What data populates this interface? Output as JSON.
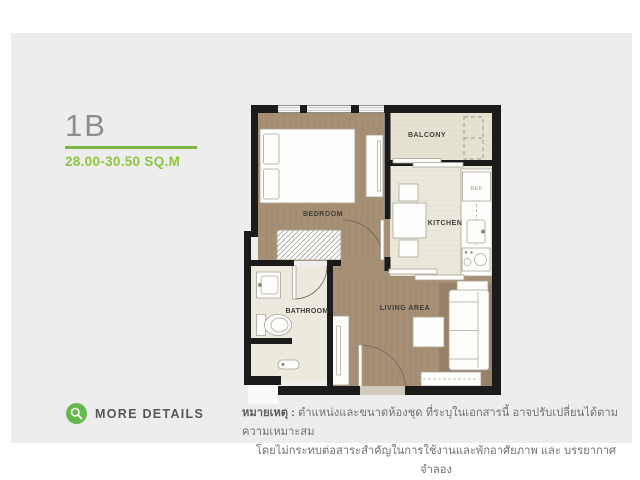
{
  "page": {
    "background": "#ffffff",
    "panel_color": "#ededed"
  },
  "unit": {
    "name": "1B",
    "area": "28.00-30.50 SQ.M",
    "accent_green": "#7cb843",
    "area_text_green": "#8cc63f",
    "title_gray": "#8b8e90"
  },
  "actions": {
    "more_details_label": "MORE DETAILS",
    "icon": "magnifier-icon",
    "icon_color": "#65b94c"
  },
  "floorplan": {
    "rooms": [
      {
        "id": "bedroom",
        "label": "BEDROOM"
      },
      {
        "id": "balcony",
        "label": "BALCONY"
      },
      {
        "id": "kitchen",
        "label": "KITCHEN"
      },
      {
        "id": "bathroom",
        "label": "BATHROOM"
      },
      {
        "id": "living",
        "label": "LIVING AREA"
      }
    ],
    "fridge_label": "REF",
    "colors": {
      "wall": "#1b1b1b",
      "wood_floor": "#a68f75",
      "wood_floor_dark": "#98816a",
      "balcony_floor": "#e6e2d2",
      "kitchen_floor": "#eae7db",
      "bathroom_floor": "#ece9de",
      "furniture_fill": "#fdfdfb",
      "furniture_stroke": "#a9a396"
    }
  },
  "note": {
    "label": "หมายเหตุ :",
    "line1": " ตำแหน่งและขนาดห้องชุด ที่ระบุในเอกสารนี้ อาจปรับเปลี่ยนได้ตามความเหมาะสม",
    "line2": "โดยไม่กระทบต่อสาระสำคัญในการใช้งานและพักอาศัยภาพ และ บรรยากาศจำลอง"
  }
}
